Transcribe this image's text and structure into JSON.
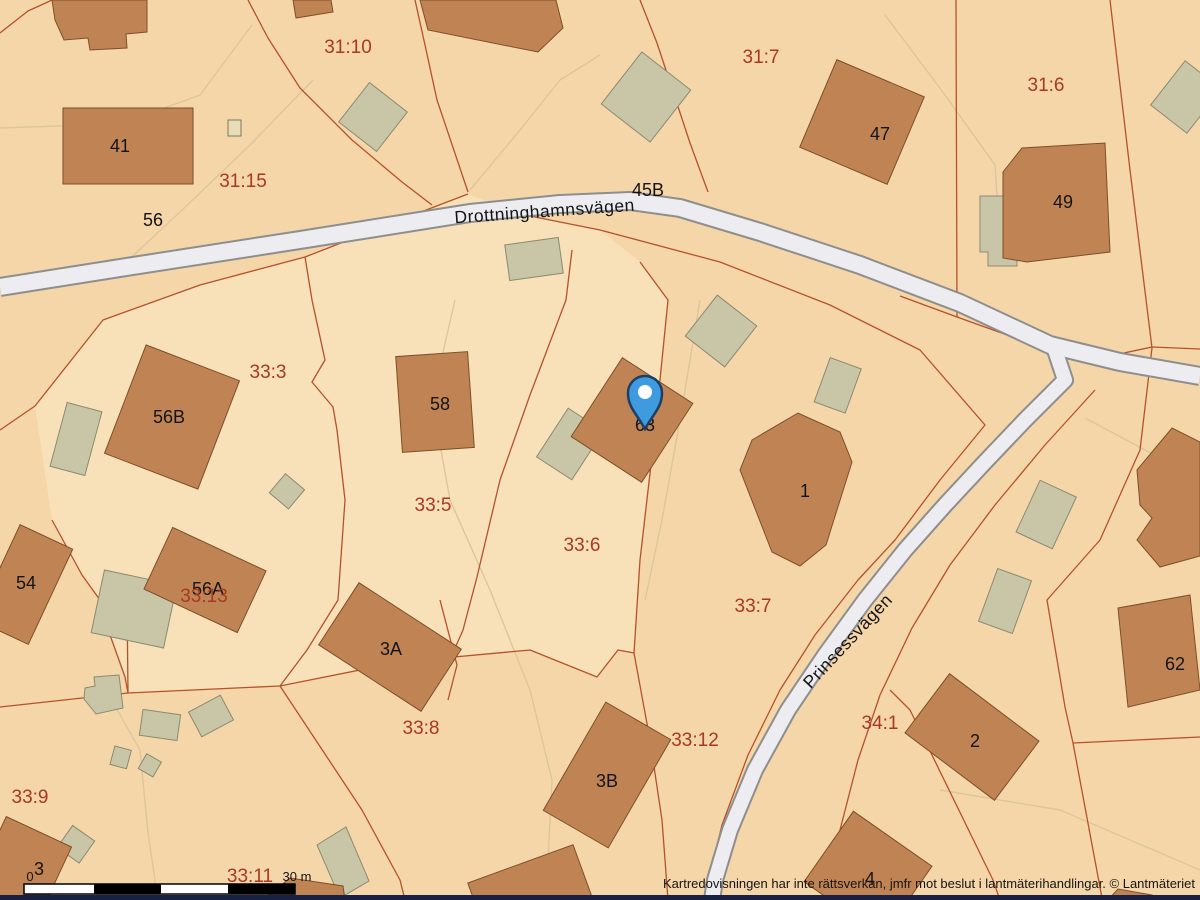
{
  "app": {
    "type": "cadastral-map-view"
  },
  "map": {
    "attribution": "Kartredovisningen har inte rättsverkan, jmfr mot beslut i lantmäterihandlingar. © Lantmäteriet",
    "scale_bar": {
      "zero_label": "0",
      "distance_label": "30 m"
    },
    "streets": {
      "main": "Drottninghamnsvägen",
      "secondary": "Prinsessvägen"
    },
    "parcels": [
      "31:10",
      "31:15",
      "31:7",
      "31:6",
      "33:3",
      "33:5",
      "33:6",
      "33:7",
      "33:13",
      "33:9",
      "33:8",
      "33:12",
      "33:11",
      "34:1"
    ],
    "buildings": [
      "41",
      "56",
      "45B",
      "47",
      "49",
      "58",
      "56B",
      "56A",
      "54",
      "1",
      "63",
      "3A",
      "3B",
      "3",
      "2",
      "62",
      "4"
    ],
    "marker": {
      "name": "location-pin",
      "fill": "#3f9be0",
      "border": "#1d3f66",
      "inner": "#ffffff"
    },
    "colors": {
      "parcel_fill": "#f5d6a8",
      "parcel_fill_light": "#f8e0b8",
      "building_fill": "#c08454",
      "outbuilding_fill": "#c9c5a7",
      "road_fill": "#ededf1",
      "boundary_line": "#b5522a",
      "parcel_label": "#a63a24",
      "building_label": "#141414",
      "footer_bar": "#182145"
    }
  }
}
